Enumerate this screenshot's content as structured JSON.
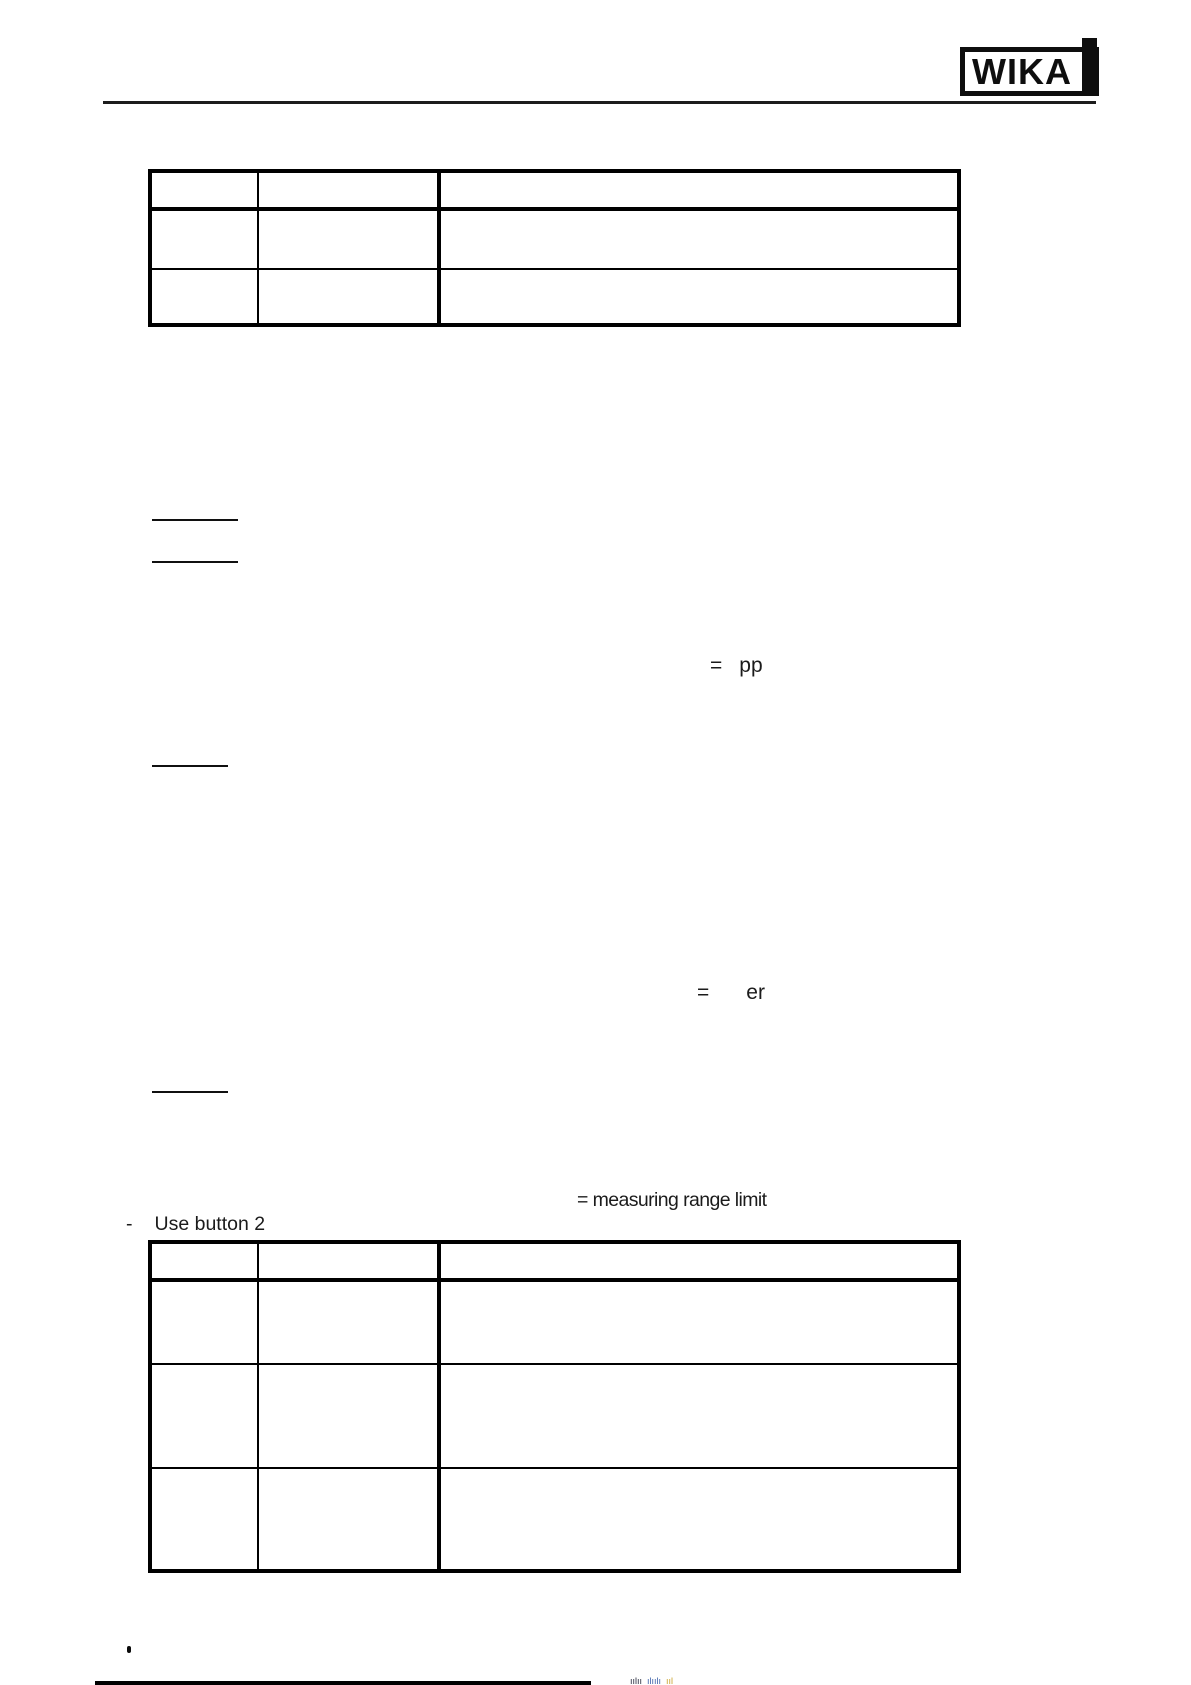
{
  "brand": {
    "logo_text": "WIKA"
  },
  "annotations": {
    "eq_pp_symbol": "=",
    "eq_pp_value": "pp",
    "eq_er_symbol": "=",
    "eq_er_value": "er",
    "measuring_range_note": "= measuring range limit",
    "list_dash": "-",
    "use_button_text": "Use button 2",
    "bullet_glyph": "•"
  },
  "tables": {
    "top": {
      "column_count": 3,
      "row_count": 3,
      "rows": [
        [
          "",
          "",
          ""
        ],
        [
          "",
          "",
          ""
        ],
        [
          "",
          "",
          ""
        ]
      ]
    },
    "bottom": {
      "column_count": 3,
      "row_count": 4,
      "rows": [
        [
          "",
          "",
          ""
        ],
        [
          "",
          "",
          ""
        ],
        [
          "",
          "",
          ""
        ],
        [
          "",
          "",
          ""
        ]
      ]
    }
  },
  "footer": {
    "clipped_text_dark": "ıılıı",
    "clipped_text_blue": "ılıılı",
    "clipped_text_yellow": "ııl"
  }
}
